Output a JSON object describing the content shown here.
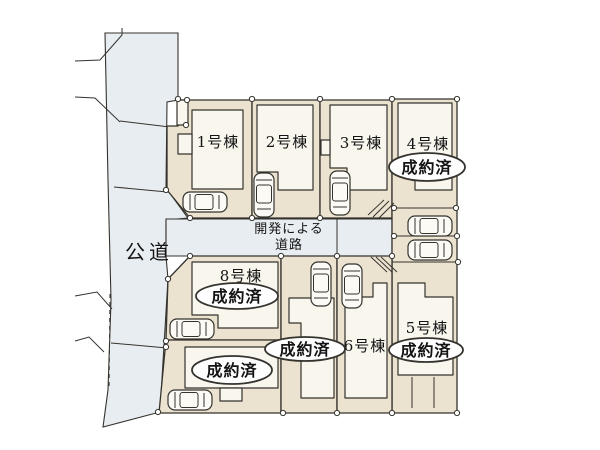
{
  "colors": {
    "background": "#ffffff",
    "line": "#35332e",
    "lot_fill": "#ebe3cf",
    "building_fill": "#f9f6ee",
    "road_fill": "#e8edf1",
    "badge_fill": "#fefefe",
    "text": "#141414"
  },
  "roads": {
    "public_road_label": "公道",
    "development_road_label_line1": "開発による",
    "development_road_label_line2": "道路"
  },
  "icons": {
    "car": "car-icon",
    "corner_marker": "corner-marker-dot",
    "slope_hatch": "slope-hatch-lines"
  },
  "lots": [
    {
      "label": "1号棟",
      "status": ""
    },
    {
      "label": "2号棟",
      "status": ""
    },
    {
      "label": "3号棟",
      "status": ""
    },
    {
      "label": "4号棟",
      "status": "成約済"
    },
    {
      "label": "5号棟",
      "status": "成約済"
    },
    {
      "label": "6号棟",
      "status": ""
    },
    {
      "label": "",
      "status": "成約済"
    },
    {
      "label": "8号棟",
      "status": "成約済"
    },
    {
      "label": "",
      "status": "成約済"
    }
  ]
}
